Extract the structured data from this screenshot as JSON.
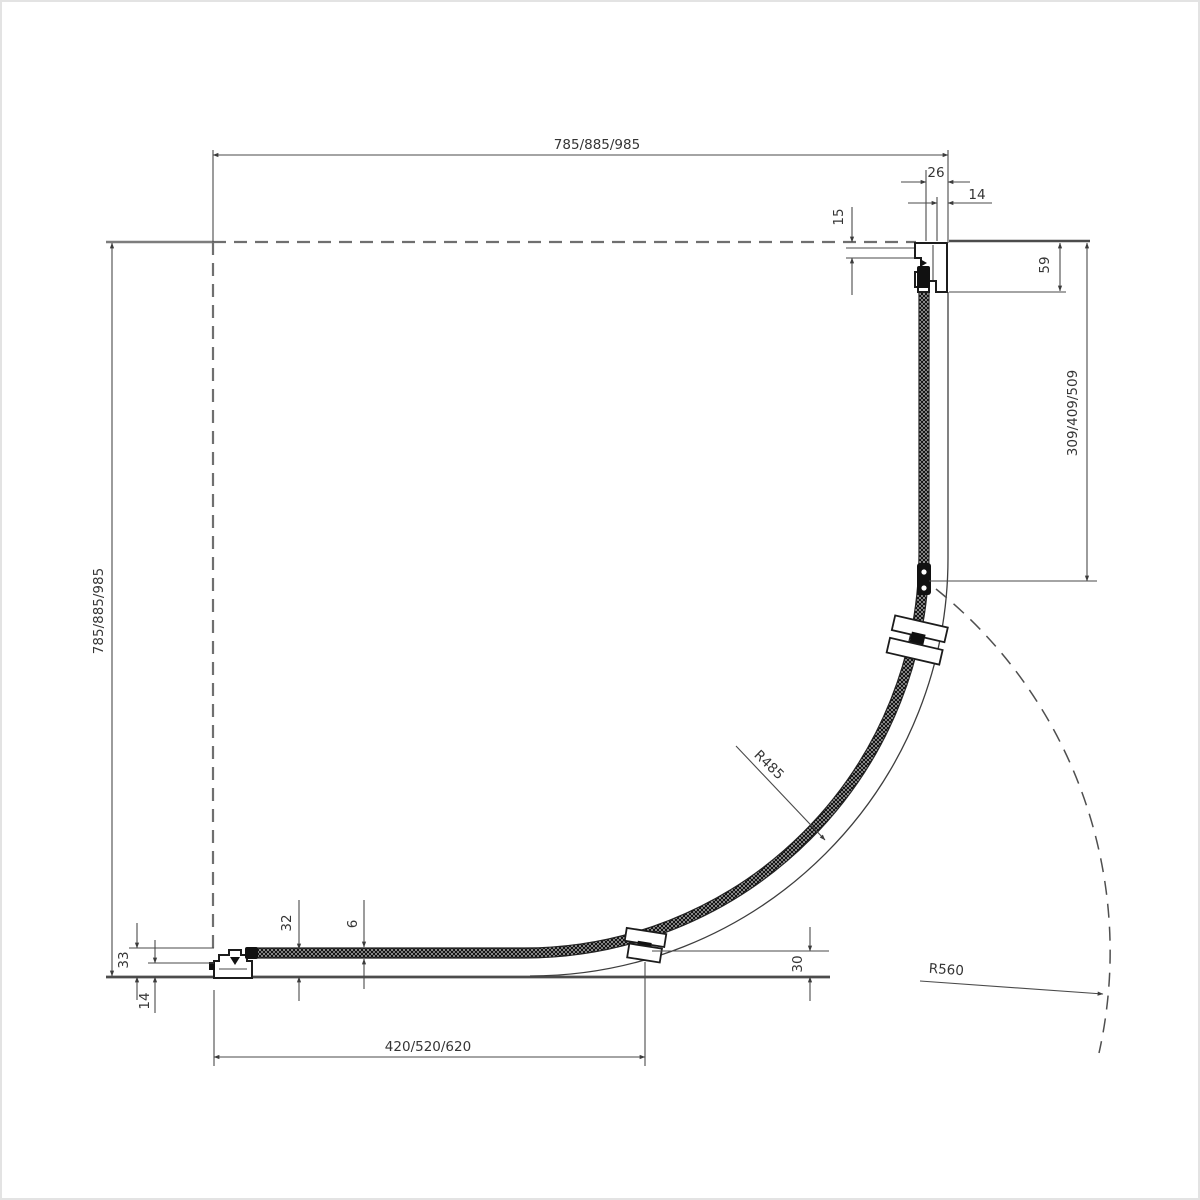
{
  "drawing": {
    "kind": "quadrant-shower-enclosure-plan-drawing",
    "labels": {
      "top_width": "785/885/985",
      "left_height": "785/885/985",
      "right_panel_width": "309/409/509",
      "bottom_door_width": "420/520/620",
      "dim_26": "26",
      "dim_14_top": "14",
      "dim_15": "15",
      "dim_59": "59",
      "dim_33": "33",
      "dim_14_bottom": "14",
      "dim_32": "32",
      "dim_6": "6",
      "dim_30": "30",
      "radius_glass": "R485",
      "radius_door_swing": "R560"
    },
    "colors": {
      "background": "#ffffff",
      "line": "#4a4a4a",
      "profile_outline": "#1c1c1c",
      "dashed_wall": "#6f6f6f",
      "image_border": "#e3e3e3",
      "text": "#353535"
    }
  }
}
